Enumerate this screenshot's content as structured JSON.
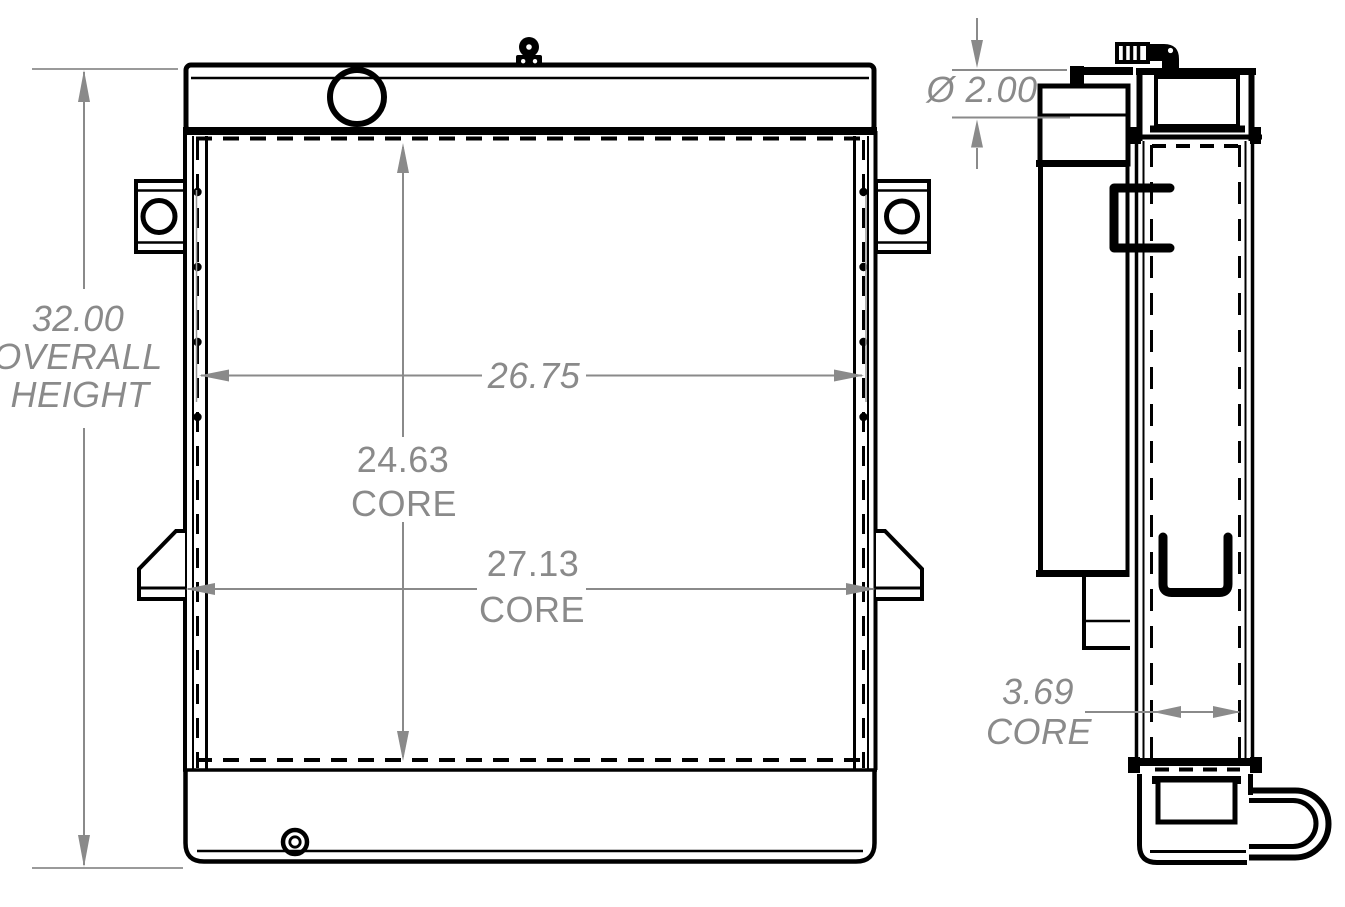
{
  "drawing": {
    "type": "radiator-technical-drawing",
    "background_color": "#ffffff",
    "line_color": "#000000",
    "dimension_color": "#8a8a8a",
    "dimensions": {
      "overall_height": {
        "value": "32.00",
        "label": [
          "OVERALL",
          "HEIGHT"
        ]
      },
      "tank_width": {
        "value": "26.75"
      },
      "core_height": {
        "value": "24.63",
        "label": "CORE"
      },
      "core_width": {
        "value": "27.13",
        "label": "CORE"
      },
      "pipe_diameter": {
        "value": "Ø 2.00"
      },
      "core_depth": {
        "value": "3.69",
        "label": "CORE"
      }
    }
  }
}
